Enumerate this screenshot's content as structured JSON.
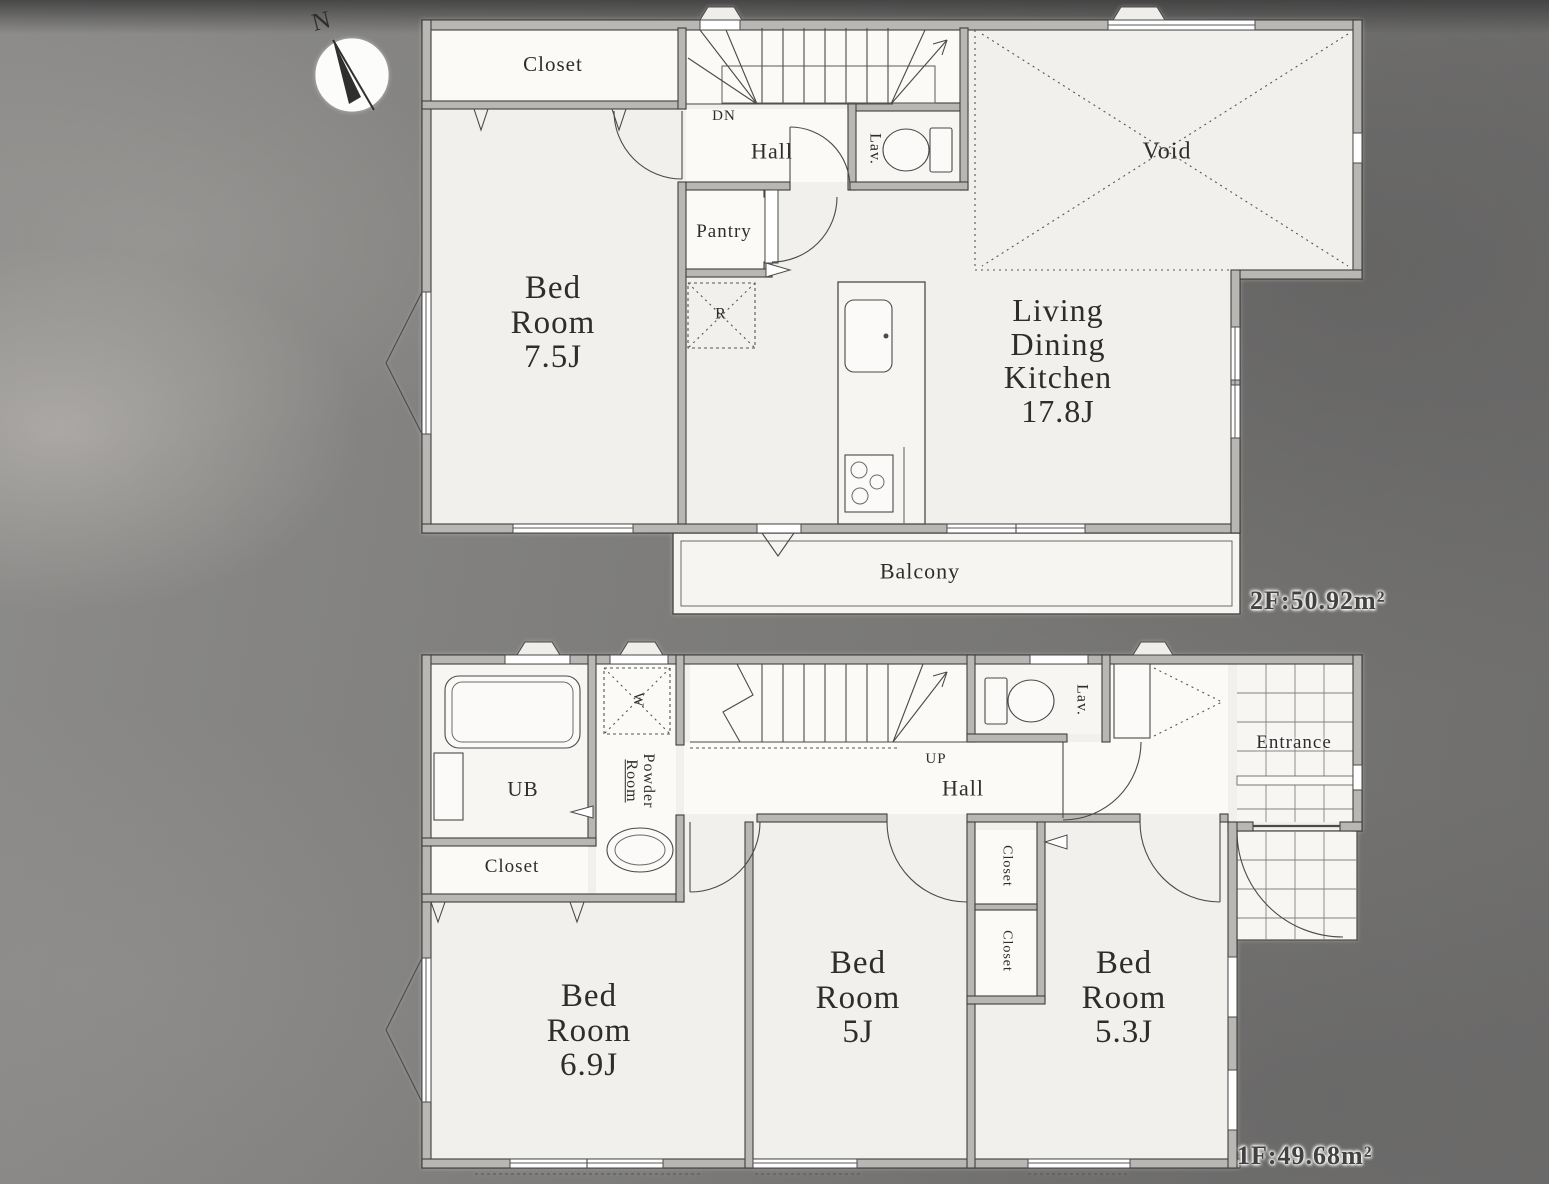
{
  "compass": {
    "north_label": "N"
  },
  "colors": {
    "paper": "#f1f0ec",
    "wall_fill": "#b8b7b4",
    "line": "#3f3f3e",
    "background": "#7b7a78"
  },
  "floor2": {
    "area_label": "2F:50.92m²",
    "closet": "Closet",
    "bedroom": {
      "l1": "Bed",
      "l2": "Room",
      "l3": "7.5J"
    },
    "stairs_dn": "DN",
    "hall": "Hall",
    "lavatory": "Lav.",
    "pantry": "Pantry",
    "refrigerator": "R",
    "void": "Void",
    "ldk": {
      "l1": "Living",
      "l2": "Dining",
      "l3": "Kitchen",
      "l4": "17.8J"
    },
    "balcony": "Balcony"
  },
  "floor1": {
    "area_label": "1F:49.68m²",
    "unit_bath": "UB",
    "washer": "W",
    "powder_room": {
      "l1": "Powder",
      "l2": "Room"
    },
    "closet_west": "Closet",
    "stairs_up": "UP",
    "hall": "Hall",
    "lavatory": "Lav.",
    "entrance": "Entrance",
    "closet_a": "Closet",
    "closet_b": "Closet",
    "bedroom_sw": {
      "l1": "Bed",
      "l2": "Room",
      "l3": "6.9J"
    },
    "bedroom_s": {
      "l1": "Bed",
      "l2": "Room",
      "l3": "5J"
    },
    "bedroom_se": {
      "l1": "Bed",
      "l2": "Room",
      "l3": "5.3J"
    }
  }
}
